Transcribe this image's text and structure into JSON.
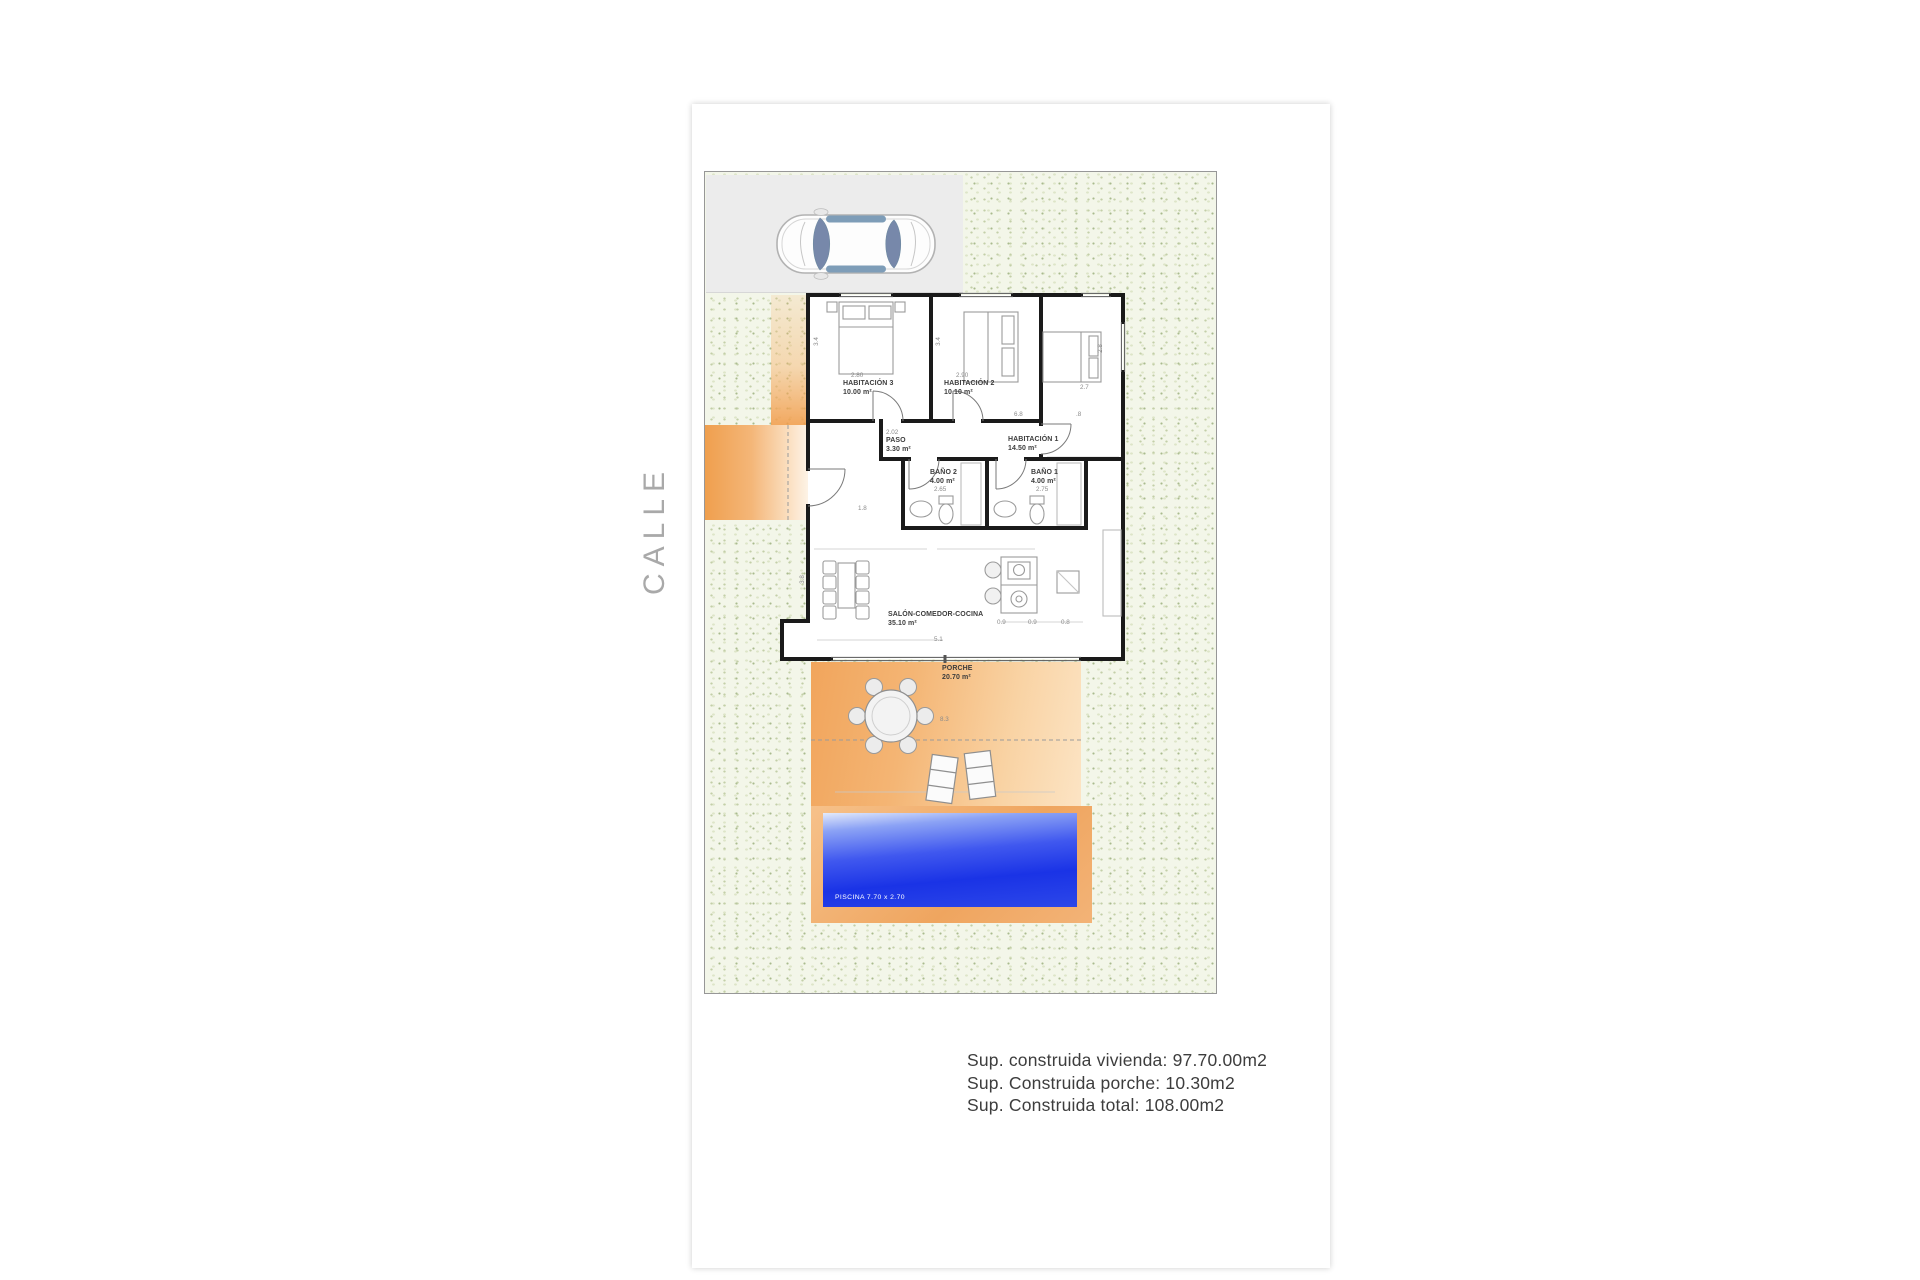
{
  "street_label": "CALLE",
  "rooms": [
    {
      "name": "HABITACIÓN 3",
      "area": "10.00 m²"
    },
    {
      "name": "HABITACIÓN 2",
      "area": "10.10 m²"
    },
    {
      "name": "HABITACIÓN 1",
      "area": "14.50 m²"
    },
    {
      "name": "PASO",
      "area": "3.30 m²"
    },
    {
      "name": "BAÑO 2",
      "area": "4.00 m²"
    },
    {
      "name": "BAÑO 1",
      "area": "4.00 m²"
    },
    {
      "name": "SALÓN-COMEDOR-COCINA",
      "area": "35.10 m²"
    },
    {
      "name": "PORCHE",
      "area": "20.70 m²"
    }
  ],
  "pool_label": "PISCINA 7.70 x 2.70",
  "dimensions": [
    "2.80",
    "2.90",
    "3.4",
    "3.4",
    "2.7",
    "2.8",
    "6.8",
    ".8",
    "2.02",
    "2.65",
    "2.75",
    "1.8",
    "3.8",
    "5.1",
    "0.9",
    "0.9",
    "0.8",
    "8.3"
  ],
  "summary": {
    "line1": "Sup. construida vivienda: 97.70.00m2",
    "line2": "Sup. Construida porche: 10.30m2",
    "line3": "Sup. Construida total: 108.00m2"
  },
  "colors": {
    "accent_orange": "#f0a45c",
    "pool_blue": "#2138e6",
    "garden_green": "#eef3e2",
    "wall_black": "#1a1a1a"
  }
}
